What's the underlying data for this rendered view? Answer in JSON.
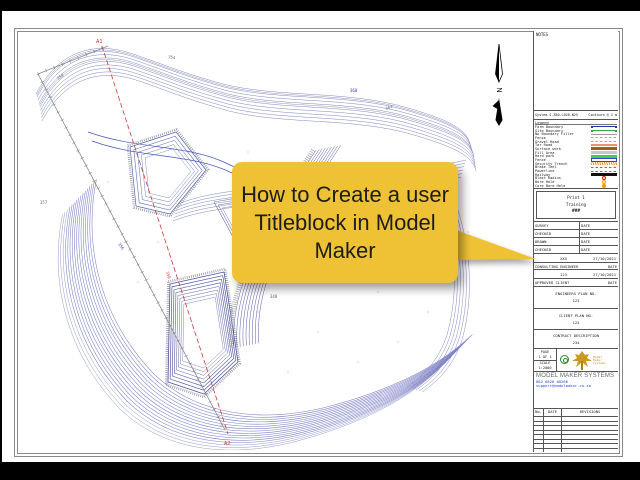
{
  "callout": {
    "text": "How to Create a user Titleblock in Model Maker",
    "bg": "#EFC235"
  },
  "drawing": {
    "section_start": "A1",
    "section_end": "A2",
    "section_mid_label": "350",
    "north_label": "N",
    "elevations": [
      "350",
      "354",
      "360",
      "362",
      "357",
      "356",
      "348",
      "344"
    ],
    "contour_color": "#7b7fc4",
    "dense_color": "#4c4f9e",
    "section_color": "#cc3a3a"
  },
  "titleblock": {
    "notes_label": "NOTES",
    "system_line": "System S-380-L028-N25",
    "contours_line": "Contours @ 1 m",
    "legend": {
      "title": "Legend",
      "items": [
        {
          "label": "Farm Boundary",
          "kind": "ends",
          "color": "#2233bb"
        },
        {
          "label": "Site Boundary",
          "kind": "ends",
          "color": "#33aa33"
        },
        {
          "label": "No Boundary Filler",
          "kind": "line",
          "color": "#999999"
        },
        {
          "label": "Fence",
          "kind": "dash",
          "color": "#aaaaaa"
        },
        {
          "label": "Gravel Road",
          "kind": "dash",
          "color": "#c8a070"
        },
        {
          "label": "Tar Road",
          "kind": "line2",
          "color": "#e89070"
        },
        {
          "label": "Surface work",
          "kind": "thick",
          "color": "#a05a28"
        },
        {
          "label": "Fill Area",
          "kind": "thick",
          "color": "#c8c8c8"
        },
        {
          "label": "Hard park",
          "kind": "thick",
          "color": "#44cc44"
        },
        {
          "label": "Fence",
          "kind": "box",
          "color": "#3344cc"
        },
        {
          "label": "Security Trench",
          "kind": "hatch",
          "color": "#ff8822"
        },
        {
          "label": "Brake Teel",
          "kind": "dash",
          "color": "#cc5544"
        },
        {
          "label": "Powerline",
          "kind": "dash",
          "color": "#33aa33"
        },
        {
          "label": "Railway",
          "kind": "thick",
          "color": "#111111"
        },
        {
          "label": "Blast Radius",
          "kind": "ring",
          "color": "#cc2200"
        },
        {
          "label": "Bore Hole",
          "kind": "ring",
          "color": "#ff9900"
        },
        {
          "label": "Core Bore Hole",
          "kind": "dot",
          "color": "#ff9900"
        }
      ]
    },
    "print": {
      "line1": "Print 1",
      "line2": "Training",
      "line3": "###"
    },
    "signoff": {
      "rows": [
        {
          "label": "SURVEY",
          "date": "DATE"
        },
        {
          "label": "CHECKED",
          "date": "DATE"
        },
        {
          "label": "DRAWN",
          "date": "DATE"
        },
        {
          "label": "CHECKED",
          "date": "DATE"
        }
      ]
    },
    "approval_row1": {
      "value": "XXX",
      "date": "27/10/2021"
    },
    "consulting": {
      "label": "CONSULTING ENGINEER",
      "date": "DATE"
    },
    "approval_row2": {
      "value": "123",
      "date": "27/10/2021"
    },
    "client": {
      "label": "APPROVED CLIENT",
      "date": "DATE"
    },
    "engineers_plan": {
      "label": "ENGINEERS PLAN NO.",
      "value": "123"
    },
    "client_plan": {
      "label": "CLIENT PLAN NO.",
      "value": "123"
    },
    "contract": {
      "label": "CONTRACT DESCRIPTION",
      "value": "234"
    },
    "pagescale": {
      "page_label": "PAGE",
      "page_value": "1 OF 1",
      "scale_label": "SCALE",
      "scale_value": "1:2000"
    },
    "company": {
      "name": "MODEL MAKER SYSTEMS",
      "address": [
        "105 Witch Hazel Ave",
        "Highveld Techno Park",
        "Centurion",
        "0876647985"
      ],
      "phone_blue": "082 0826 08266",
      "email": "support@modelmaker.co.za",
      "logo_text": "Model Maker Systems"
    },
    "revisions": {
      "no": "No.",
      "date": "DATE",
      "title": "REVISIONS",
      "empty_rows": 8
    }
  }
}
